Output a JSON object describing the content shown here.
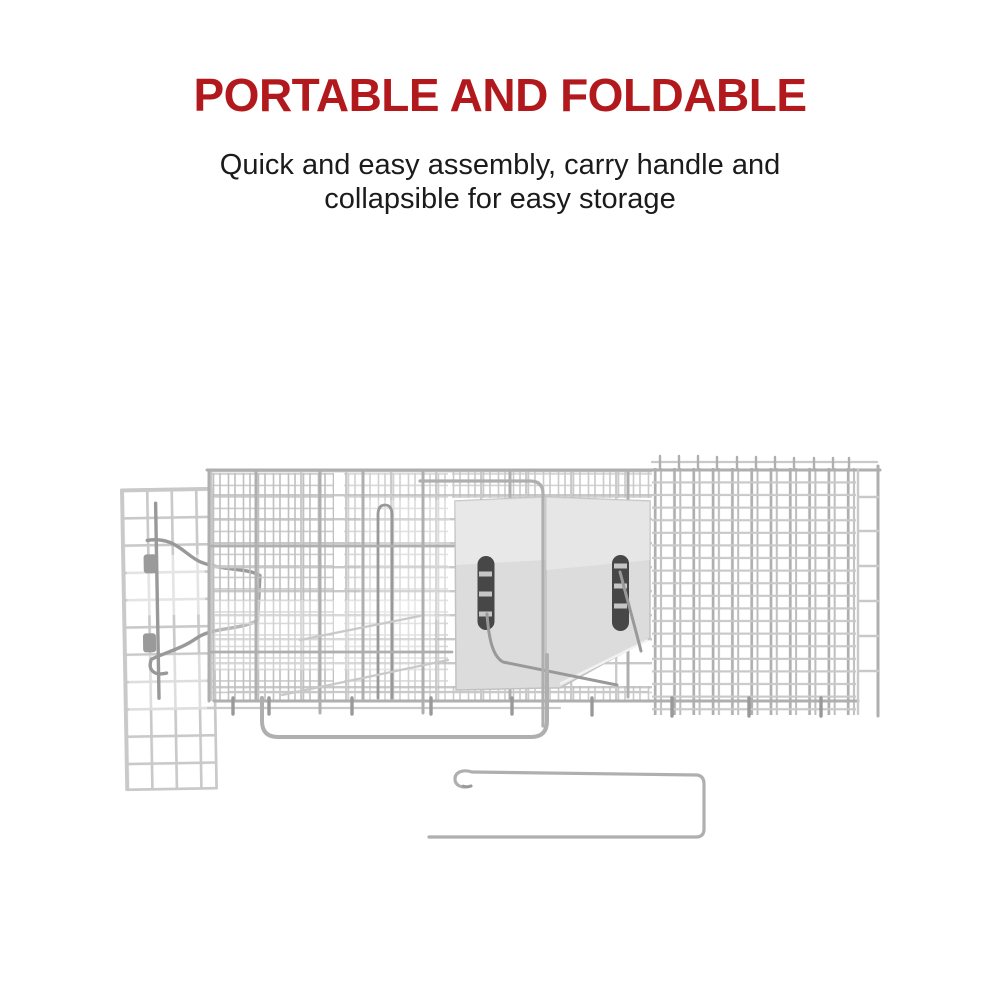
{
  "page": {
    "background_color": "#ffffff"
  },
  "header": {
    "title": "PORTABLE AND FOLDABLE",
    "title_color": "#b2191d",
    "subtitle_line1": "Quick and easy assembly, carry handle and",
    "subtitle_line2": "collapsible for easy storage",
    "subtitle_color": "#1b1b1b"
  },
  "figure": {
    "subject": "folded-collapsible-trap-cage-with-trigger-rod",
    "palette": {
      "wire_light": "#c9c9c9",
      "wire_soft": "#bdbdbd",
      "wire_mid": "#afafaf",
      "wire_dark": "#999999",
      "plate_fill": "#dcdcdc",
      "plate_edge": "#c2c2c2",
      "slot_fill": "#474747"
    }
  }
}
